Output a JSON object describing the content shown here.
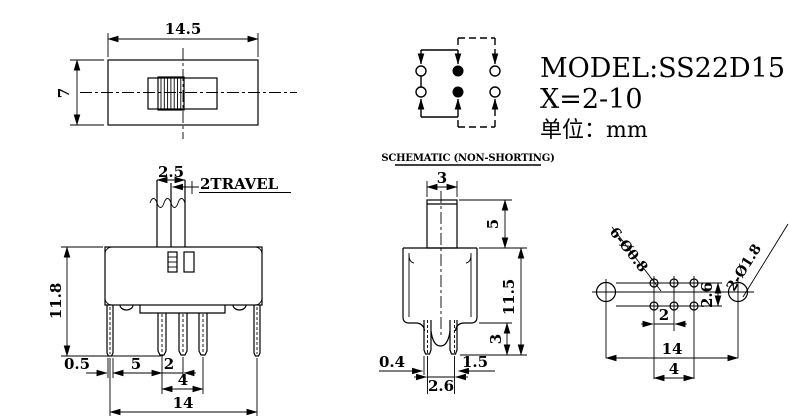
{
  "colors": {
    "ink": "#000000",
    "background": "#ffffff"
  },
  "title": {
    "model": "MODEL:SS22D15",
    "x_range": "X=2-10",
    "unit": "单位：mm"
  },
  "schematic": {
    "caption": "SCHEMATIC (NON-SHORTING)"
  },
  "top_view": {
    "body_width": "14.5",
    "body_height": "7"
  },
  "front_view": {
    "knob_width": "2.5",
    "travel_label": "2TRAVEL",
    "total_height": "11.8",
    "bracket_thickness": "0.5",
    "bracket_to_pin": "5",
    "pin_pitch": "2",
    "pin_span": "4",
    "bracket_span": "14"
  },
  "side_view": {
    "knob_width": "3",
    "knob_height": "5",
    "body_height": "11.5",
    "pin_length": "3",
    "pin_thickness": "0.4",
    "pin_width": "1.5",
    "pin_pitch": "2.6"
  },
  "pcb_view": {
    "terminal_holes_label": "6-Ø0.8",
    "mounting_holes_label": "2-Ø1.8",
    "row_pitch": "2.6",
    "col_pitch": "2",
    "mounting_span": "14",
    "terminal_span": "4"
  }
}
